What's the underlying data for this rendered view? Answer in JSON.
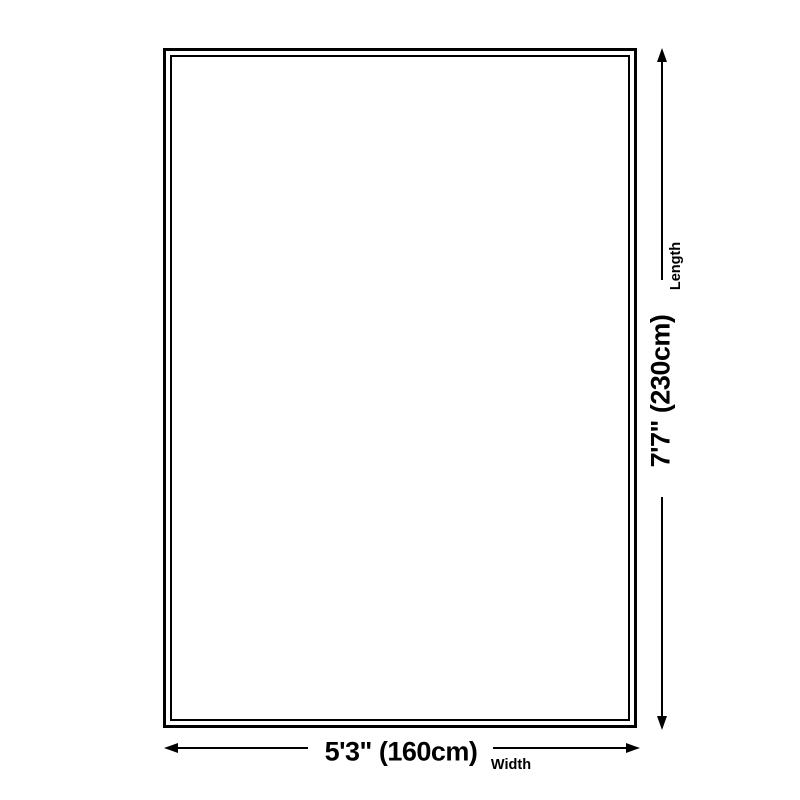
{
  "diagram": {
    "background_color": "#ffffff",
    "line_color": "#000000",
    "product_outline": {
      "style": "double-border-rectangle"
    },
    "dimensions": {
      "length": {
        "value": "7'7\" (230cm)",
        "label": "Length"
      },
      "width": {
        "value": "5'3\" (160cm)",
        "label": "Width"
      }
    }
  }
}
